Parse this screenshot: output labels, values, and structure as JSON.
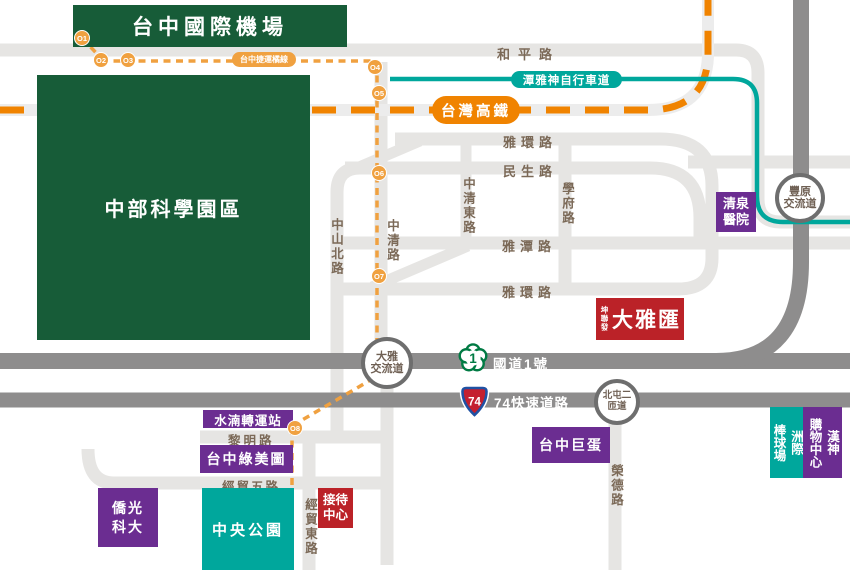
{
  "title": "大雅匯 location map",
  "colors": {
    "green_box": "#175c38",
    "purple_box": "#6b2d91",
    "teal_box": "#00a79c",
    "red_box": "#bb2228",
    "road_light": "#e6e5e3",
    "road_dark": "#8e8d8d",
    "road_label": "#7b6957",
    "mrt_orange": "#f0a140",
    "hsr_orange": "#f08300",
    "bike_teal": "#00a79c"
  },
  "places": {
    "airport": "台中國際機場",
    "science_park": "中部科學園區",
    "hospital": "清泉\n醫院",
    "project": {
      "brand": "坤聯發",
      "name": "大雅匯"
    },
    "dome": "台中巨蛋",
    "baseball_stadium": "洲際\n棒球場",
    "mall": "漢神\n購物中心",
    "transfer_station": "水湳轉運站",
    "green_museum": "台中綠美圖",
    "central_park": "中央公園",
    "university": "僑光\n科大",
    "reception_center": "接待\n中心"
  },
  "roads": {
    "heping": "和平路",
    "yahuan_north": "雅環路",
    "minsheng": "民生路",
    "yatan": "雅潭路",
    "yahuan_south": "雅環路",
    "zhongshan_north": "中山北路",
    "zhongqing": "中清路",
    "zhongqing_east": "中清東路",
    "xuefu": "學府路",
    "liming": "黎明路",
    "jingmao_5th": "經貿五路",
    "jingmao_east": "經貿東路",
    "rongde": "榮德路"
  },
  "highways": {
    "national1": {
      "shield": "1",
      "label": "國道1號"
    },
    "expressway74": {
      "shield": "74",
      "label": "74快速道路"
    }
  },
  "interchanges": {
    "fengyuan": "豐原\n交流道",
    "daya": "大雅\n交流道",
    "beitun2": "北屯二\n匝道"
  },
  "transit": {
    "mrt": {
      "label": "台中捷運橘線",
      "stops": [
        {
          "id": "O1"
        },
        {
          "id": "O2"
        },
        {
          "id": "O3"
        },
        {
          "id": "O4"
        },
        {
          "id": "O5"
        },
        {
          "id": "O6"
        },
        {
          "id": "O7"
        },
        {
          "id": "O8"
        }
      ]
    },
    "hsr": {
      "label": "台灣高鐵"
    },
    "bike_path": {
      "label": "潭雅神自行車道"
    }
  }
}
